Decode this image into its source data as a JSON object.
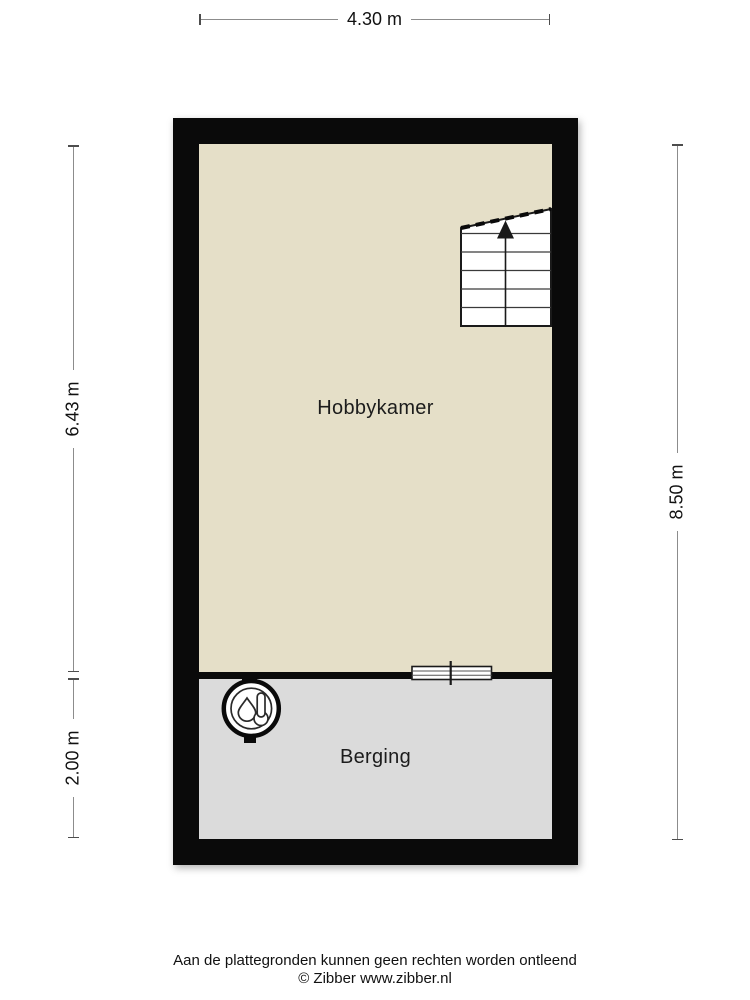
{
  "page": {
    "background_color": "#ffffff"
  },
  "floorplan": {
    "wall_color": "#0a0a0a",
    "rooms": [
      {
        "name": "Hobbykamer",
        "floor_color": "#e5dfc8"
      },
      {
        "name": "Berging",
        "floor_color": "#dbdbdb"
      }
    ],
    "icons": [
      {
        "name": "stairs-up-arrow-icon"
      },
      {
        "name": "window-divider-icon"
      },
      {
        "name": "boiler-icon"
      }
    ]
  },
  "dimensions": {
    "top_width": "4.30 m",
    "left_upper_height": "6.43 m",
    "left_lower_height": "2.00 m",
    "right_height": "8.50 m"
  },
  "footer": {
    "disclaimer": "Aan de plattegronden kunnen geen rechten worden ontleend",
    "copyright": "© Zibber www.zibber.nl"
  }
}
